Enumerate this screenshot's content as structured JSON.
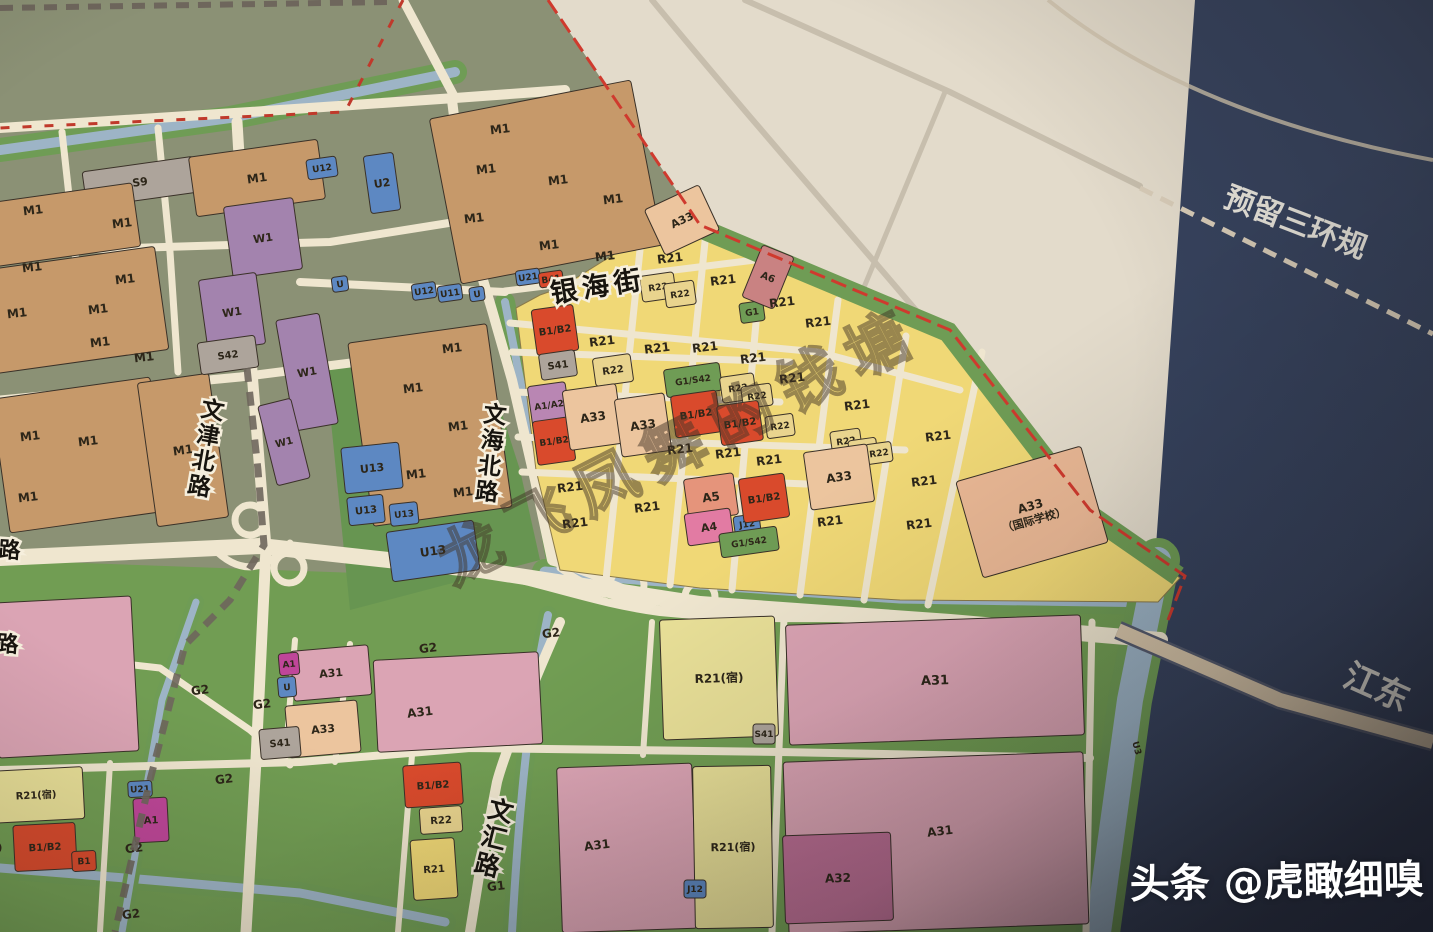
{
  "palette": {
    "m1": "#c6996a",
    "w1": "#a383ae",
    "s": "#ada49b",
    "u": "#5d88c2",
    "r21": "#f0d876",
    "r21s": "#e9e098",
    "r22": "#e9d48e",
    "b12": "#d94a2c",
    "a12": "#b986b3",
    "a33": "#ecc59e",
    "school": "#eab895",
    "a4": "#e27ba3",
    "a5": "#e5947b",
    "a6": "#c98282",
    "a1m": "#bf4699",
    "g": "#6f9c55",
    "pink": "#dba4b4",
    "a32": "#bd6f95",
    "none": ""
  },
  "annotations": {
    "reserved_corridor": {
      "text": "预留三环规"
    },
    "east_river_road": {
      "text": "江东"
    },
    "map_watermark": {
      "text": "龙飞凤舞的钱塘"
    },
    "photo_watermark": {
      "text": "头条 @虎瞰细嗅"
    }
  },
  "streets": [
    {
      "n": "银海街",
      "x": 598,
      "y": 286,
      "r": -9,
      "v": false,
      "s": 27
    },
    {
      "n": "文津北路",
      "x": 206,
      "y": 448,
      "r": 10,
      "v": true,
      "s": 23
    },
    {
      "n": "文海北路",
      "x": 491,
      "y": 453,
      "r": 6,
      "v": true,
      "s": 23
    },
    {
      "n": "文汇路",
      "x": 494,
      "y": 838,
      "r": 14,
      "v": true,
      "s": 25
    },
    {
      "n": "路",
      "x": 12,
      "y": 550,
      "r": 4,
      "v": false,
      "s": 22
    },
    {
      "n": "路",
      "x": 10,
      "y": 644,
      "r": 4,
      "v": false,
      "s": 22
    }
  ],
  "zones": [
    {
      "l": "S9",
      "x": 140,
      "y": 182,
      "w": 112,
      "h": 36,
      "r": -8,
      "c": "s",
      "s": 11
    },
    {
      "l": "",
      "x": 62,
      "y": 225,
      "w": 150,
      "h": 64,
      "r": -8,
      "c": "m1"
    },
    {
      "l": "M1",
      "x": 33,
      "y": 210,
      "w": 0,
      "c": "none"
    },
    {
      "l": "M1",
      "x": 122,
      "y": 223,
      "w": 0,
      "c": "none"
    },
    {
      "l": "M1",
      "x": 257,
      "y": 178,
      "w": 130,
      "h": 60,
      "r": -8,
      "c": "m1"
    },
    {
      "l": "",
      "x": 75,
      "y": 310,
      "w": 175,
      "h": 104,
      "r": -8,
      "c": "m1"
    },
    {
      "l": "M1",
      "x": 32,
      "y": 267,
      "w": 0,
      "c": "none"
    },
    {
      "l": "M1",
      "x": 125,
      "y": 279,
      "w": 0,
      "c": "none"
    },
    {
      "l": "M1",
      "x": 17,
      "y": 313,
      "w": 0,
      "c": "none"
    },
    {
      "l": "M1",
      "x": 98,
      "y": 309,
      "w": 0,
      "c": "none"
    },
    {
      "l": "M1",
      "x": 100,
      "y": 342,
      "w": 0,
      "c": "none"
    },
    {
      "l": "M1",
      "x": 144,
      "y": 357,
      "w": 0,
      "c": "none"
    },
    {
      "l": "",
      "x": 80,
      "y": 455,
      "w": 160,
      "h": 135,
      "r": -8,
      "c": "m1"
    },
    {
      "l": "M1",
      "x": 30,
      "y": 436,
      "w": 0,
      "c": "none"
    },
    {
      "l": "M1",
      "x": 88,
      "y": 441,
      "w": 0,
      "c": "none"
    },
    {
      "l": "M1",
      "x": 28,
      "y": 497,
      "w": 0,
      "c": "none"
    },
    {
      "l": "M1",
      "x": 183,
      "y": 450,
      "w": 72,
      "h": 145,
      "r": -8,
      "c": "m1"
    },
    {
      "l": "W1",
      "x": 263,
      "y": 238,
      "w": 70,
      "h": 72,
      "r": -8,
      "c": "w1",
      "s": 11
    },
    {
      "l": "W1",
      "x": 232,
      "y": 312,
      "w": 58,
      "h": 72,
      "r": -8,
      "c": "w1",
      "s": 11
    },
    {
      "l": "S42",
      "x": 228,
      "y": 355,
      "w": 58,
      "h": 32,
      "r": -8,
      "c": "s",
      "s": 10
    },
    {
      "l": "W1",
      "x": 307,
      "y": 372,
      "w": 44,
      "h": 112,
      "r": -10,
      "c": "w1",
      "s": 11
    },
    {
      "l": "W1",
      "x": 284,
      "y": 442,
      "w": 34,
      "h": 82,
      "r": -14,
      "c": "w1",
      "s": 10
    },
    {
      "l": "U12",
      "x": 322,
      "y": 168,
      "w": 30,
      "h": 20,
      "r": -8,
      "c": "u",
      "s": 9
    },
    {
      "l": "U2",
      "x": 382,
      "y": 183,
      "w": 30,
      "h": 58,
      "r": -8,
      "c": "u",
      "s": 11
    },
    {
      "l": "",
      "x": 546,
      "y": 182,
      "w": 205,
      "h": 168,
      "r": -11,
      "c": "m1"
    },
    {
      "l": "M1",
      "x": 500,
      "y": 129,
      "w": 0,
      "c": "none"
    },
    {
      "l": "M1",
      "x": 486,
      "y": 169,
      "w": 0,
      "c": "none"
    },
    {
      "l": "M1",
      "x": 558,
      "y": 180,
      "w": 0,
      "c": "none"
    },
    {
      "l": "M1",
      "x": 613,
      "y": 199,
      "w": 0,
      "c": "none"
    },
    {
      "l": "M1",
      "x": 474,
      "y": 218,
      "w": 0,
      "c": "none"
    },
    {
      "l": "M1",
      "x": 549,
      "y": 245,
      "w": 0,
      "c": "none"
    },
    {
      "l": "M1",
      "x": 605,
      "y": 256,
      "w": 0,
      "c": "none"
    },
    {
      "l": "A33",
      "x": 682,
      "y": 220,
      "w": 60,
      "h": 50,
      "r": -25,
      "c": "a33",
      "s": 11
    },
    {
      "l": "",
      "x": 430,
      "y": 425,
      "w": 140,
      "h": 185,
      "r": -8,
      "c": "m1"
    },
    {
      "l": "M1",
      "x": 452,
      "y": 348,
      "w": 0,
      "c": "none"
    },
    {
      "l": "M1",
      "x": 413,
      "y": 388,
      "w": 0,
      "c": "none"
    },
    {
      "l": "M1",
      "x": 458,
      "y": 426,
      "w": 0,
      "c": "none"
    },
    {
      "l": "M1",
      "x": 416,
      "y": 474,
      "w": 0,
      "c": "none"
    },
    {
      "l": "M1",
      "x": 463,
      "y": 492,
      "w": 0,
      "c": "none"
    },
    {
      "l": "U",
      "x": 340,
      "y": 284,
      "w": 16,
      "h": 15,
      "r": -8,
      "c": "u",
      "s": 9
    },
    {
      "l": "U12",
      "x": 424,
      "y": 291,
      "w": 24,
      "h": 16,
      "r": -8,
      "c": "u",
      "s": 9
    },
    {
      "l": "U11",
      "x": 450,
      "y": 293,
      "w": 24,
      "h": 16,
      "r": -8,
      "c": "u",
      "s": 9
    },
    {
      "l": "U",
      "x": 477,
      "y": 294,
      "w": 15,
      "h": 14,
      "r": -8,
      "c": "u",
      "s": 9
    },
    {
      "l": "U21",
      "x": 528,
      "y": 277,
      "w": 24,
      "h": 15,
      "r": -8,
      "c": "u",
      "s": 9
    },
    {
      "l": "B41",
      "x": 551,
      "y": 279,
      "w": 24,
      "h": 15,
      "r": -8,
      "c": "b12",
      "s": 9
    },
    {
      "l": "U13",
      "x": 372,
      "y": 468,
      "w": 58,
      "h": 46,
      "r": -6,
      "c": "u",
      "s": 11
    },
    {
      "l": "U13",
      "x": 366,
      "y": 510,
      "w": 36,
      "h": 28,
      "r": -6,
      "c": "u",
      "s": 10
    },
    {
      "l": "U13",
      "x": 404,
      "y": 514,
      "w": 28,
      "h": 22,
      "r": -6,
      "c": "u",
      "s": 9
    },
    {
      "l": "U13",
      "x": 433,
      "y": 551,
      "w": 88,
      "h": 50,
      "r": -8,
      "c": "u",
      "s": 12
    },
    {
      "l": "B1/B2",
      "x": 555,
      "y": 330,
      "w": 42,
      "h": 46,
      "r": -8,
      "c": "b12",
      "s": 10
    },
    {
      "l": "S41",
      "x": 558,
      "y": 365,
      "w": 36,
      "h": 26,
      "r": -8,
      "c": "s",
      "s": 10
    },
    {
      "l": "A1/A2",
      "x": 549,
      "y": 405,
      "w": 38,
      "h": 42,
      "r": -8,
      "c": "a12",
      "s": 9
    },
    {
      "l": "B1/B2",
      "x": 554,
      "y": 441,
      "w": 38,
      "h": 44,
      "r": -8,
      "c": "b12",
      "s": 9
    },
    {
      "l": "R22",
      "x": 613,
      "y": 370,
      "w": 38,
      "h": 28,
      "r": -8,
      "c": "r22",
      "s": 10
    },
    {
      "l": "A33",
      "x": 593,
      "y": 417,
      "w": 54,
      "h": 60,
      "r": -8,
      "c": "a33",
      "s": 12
    },
    {
      "l": "A33",
      "x": 643,
      "y": 425,
      "w": 50,
      "h": 58,
      "r": -8,
      "c": "a33",
      "s": 12
    },
    {
      "l": "R22",
      "x": 658,
      "y": 287,
      "w": 34,
      "h": 26,
      "r": -8,
      "c": "r22",
      "s": 9
    },
    {
      "l": "R22",
      "x": 680,
      "y": 294,
      "w": 30,
      "h": 24,
      "r": -8,
      "c": "r22",
      "s": 9
    },
    {
      "l": "G1/S42",
      "x": 693,
      "y": 380,
      "w": 56,
      "h": 28,
      "r": -8,
      "c": "g",
      "s": 9
    },
    {
      "l": "B1/B2",
      "x": 696,
      "y": 414,
      "w": 46,
      "h": 42,
      "r": -8,
      "c": "b12",
      "s": 10
    },
    {
      "l": "A5",
      "x": 711,
      "y": 497,
      "w": 50,
      "h": 42,
      "r": -8,
      "c": "a5",
      "s": 12
    },
    {
      "l": "A4",
      "x": 709,
      "y": 527,
      "w": 46,
      "h": 32,
      "r": -8,
      "c": "a4",
      "s": 11
    },
    {
      "l": "J12",
      "x": 747,
      "y": 524,
      "w": 26,
      "h": 18,
      "r": -8,
      "c": "u",
      "s": 9
    },
    {
      "l": "G1/S42",
      "x": 749,
      "y": 542,
      "w": 58,
      "h": 24,
      "r": -8,
      "c": "g",
      "s": 9
    },
    {
      "l": "G1",
      "x": 752,
      "y": 312,
      "w": 24,
      "h": 20,
      "r": -8,
      "c": "g",
      "s": 9
    },
    {
      "l": "A6",
      "x": 768,
      "y": 277,
      "w": 34,
      "h": 56,
      "r": 22,
      "c": "a6",
      "s": 10
    },
    {
      "l": "R22",
      "x": 738,
      "y": 388,
      "w": 34,
      "h": 26,
      "r": -8,
      "c": "r22",
      "s": 9
    },
    {
      "l": "R22",
      "x": 757,
      "y": 396,
      "w": 30,
      "h": 22,
      "r": -8,
      "c": "r22",
      "s": 9
    },
    {
      "l": "B1/B2",
      "x": 740,
      "y": 423,
      "w": 42,
      "h": 40,
      "r": -8,
      "c": "b12",
      "s": 10
    },
    {
      "l": "R22",
      "x": 780,
      "y": 426,
      "w": 28,
      "h": 22,
      "r": -8,
      "c": "r22",
      "s": 9
    },
    {
      "l": "B1/B2",
      "x": 764,
      "y": 498,
      "w": 46,
      "h": 44,
      "r": -8,
      "c": "b12",
      "s": 10
    },
    {
      "l": "R22",
      "x": 846,
      "y": 441,
      "w": 30,
      "h": 22,
      "r": -8,
      "c": "r22",
      "s": 9
    },
    {
      "l": "R22",
      "x": 863,
      "y": 449,
      "w": 28,
      "h": 20,
      "r": -8,
      "c": "r22",
      "s": 9
    },
    {
      "l": "R22",
      "x": 879,
      "y": 453,
      "w": 26,
      "h": 20,
      "r": -8,
      "c": "r22",
      "s": 9
    },
    {
      "l": "A33",
      "x": 839,
      "y": 477,
      "w": 64,
      "h": 58,
      "r": -8,
      "c": "a33",
      "s": 12
    },
    {
      "l": "A33",
      "l2": "（国际学校）",
      "x": 1032,
      "y": 512,
      "w": 130,
      "h": 100,
      "r": -16,
      "c": "school",
      "s": 12
    },
    {
      "l": "R21",
      "x": 670,
      "y": 258,
      "w": 0,
      "c": "none"
    },
    {
      "l": "R21",
      "x": 723,
      "y": 280,
      "w": 0,
      "c": "none"
    },
    {
      "l": "R21",
      "x": 782,
      "y": 302,
      "w": 0,
      "c": "none"
    },
    {
      "l": "R21",
      "x": 818,
      "y": 322,
      "w": 0,
      "c": "none"
    },
    {
      "l": "R21",
      "x": 602,
      "y": 341,
      "w": 0,
      "c": "none"
    },
    {
      "l": "R21",
      "x": 657,
      "y": 348,
      "w": 0,
      "c": "none"
    },
    {
      "l": "R21",
      "x": 705,
      "y": 347,
      "w": 0,
      "c": "none"
    },
    {
      "l": "R21",
      "x": 753,
      "y": 358,
      "w": 0,
      "c": "none"
    },
    {
      "l": "R21",
      "x": 792,
      "y": 378,
      "w": 0,
      "c": "none"
    },
    {
      "l": "R21",
      "x": 857,
      "y": 405,
      "w": 0,
      "c": "none"
    },
    {
      "l": "R21",
      "x": 938,
      "y": 436,
      "w": 0,
      "c": "none"
    },
    {
      "l": "R21",
      "x": 680,
      "y": 449,
      "w": 0,
      "c": "none"
    },
    {
      "l": "R21",
      "x": 728,
      "y": 453,
      "w": 0,
      "c": "none"
    },
    {
      "l": "R21",
      "x": 769,
      "y": 460,
      "w": 0,
      "c": "none"
    },
    {
      "l": "R21",
      "x": 924,
      "y": 481,
      "w": 0,
      "c": "none"
    },
    {
      "l": "R21",
      "x": 570,
      "y": 487,
      "w": 0,
      "c": "none"
    },
    {
      "l": "R21",
      "x": 647,
      "y": 507,
      "w": 0,
      "c": "none"
    },
    {
      "l": "R21",
      "x": 575,
      "y": 523,
      "w": 0,
      "c": "none"
    },
    {
      "l": "R21",
      "x": 830,
      "y": 521,
      "w": 0,
      "c": "none"
    },
    {
      "l": "R21",
      "x": 919,
      "y": 524,
      "w": 0,
      "c": "none"
    },
    {
      "l": "",
      "x": 65,
      "y": 677,
      "w": 140,
      "h": 155,
      "r": -3,
      "c": "pink"
    },
    {
      "l": "A31",
      "x": 331,
      "y": 673,
      "w": 78,
      "h": 50,
      "r": -5,
      "c": "pink",
      "s": 11
    },
    {
      "l": "A1",
      "x": 289,
      "y": 664,
      "w": 20,
      "h": 22,
      "r": -5,
      "c": "a1m",
      "s": 9
    },
    {
      "l": "U",
      "x": 287,
      "y": 687,
      "w": 18,
      "h": 20,
      "r": -5,
      "c": "u",
      "s": 9
    },
    {
      "l": "A33",
      "x": 323,
      "y": 729,
      "w": 72,
      "h": 52,
      "r": -5,
      "c": "a33",
      "s": 11
    },
    {
      "l": "S41",
      "x": 280,
      "y": 743,
      "w": 40,
      "h": 30,
      "r": -5,
      "c": "s",
      "s": 10
    },
    {
      "l": "",
      "x": 458,
      "y": 702,
      "w": 165,
      "h": 92,
      "r": -3,
      "c": "pink"
    },
    {
      "l": "A31",
      "x": 420,
      "y": 712,
      "w": 0,
      "c": "none"
    },
    {
      "l": "G2",
      "x": 428,
      "y": 648,
      "w": 0,
      "c": "none"
    },
    {
      "l": "G2",
      "x": 551,
      "y": 633,
      "w": 0,
      "c": "none"
    },
    {
      "l": "R21(宿)",
      "x": 719,
      "y": 678,
      "w": 115,
      "h": 120,
      "r": -2,
      "c": "r21s",
      "s": 12
    },
    {
      "l": "S41",
      "x": 764,
      "y": 734,
      "w": 22,
      "h": 20,
      "r": 0,
      "c": "s",
      "s": 9
    },
    {
      "l": "A31",
      "x": 935,
      "y": 680,
      "w": 295,
      "h": 120,
      "r": -2,
      "c": "pink",
      "s": 13
    },
    {
      "l": "B1/B2",
      "x": 433,
      "y": 785,
      "w": 58,
      "h": 42,
      "r": -4,
      "c": "b12",
      "s": 10
    },
    {
      "l": "R22",
      "x": 441,
      "y": 820,
      "w": 42,
      "h": 26,
      "r": -4,
      "c": "r22",
      "s": 10
    },
    {
      "l": "R21",
      "x": 434,
      "y": 869,
      "w": 44,
      "h": 60,
      "r": -4,
      "c": "r21",
      "s": 10
    },
    {
      "l": "G1",
      "x": 496,
      "y": 886,
      "w": 0,
      "c": "none"
    },
    {
      "l": "",
      "x": 627,
      "y": 848,
      "w": 135,
      "h": 165,
      "r": -2,
      "c": "pink"
    },
    {
      "l": "A31",
      "x": 597,
      "y": 845,
      "w": 0,
      "c": "none"
    },
    {
      "l": "R21(宿)",
      "x": 733,
      "y": 847,
      "w": 78,
      "h": 162,
      "r": -1,
      "c": "r21s",
      "s": 11
    },
    {
      "l": "J12",
      "x": 695,
      "y": 889,
      "w": 22,
      "h": 18,
      "r": 0,
      "c": "u",
      "s": 9
    },
    {
      "l": "",
      "x": 936,
      "y": 843,
      "w": 300,
      "h": 172,
      "r": -2,
      "c": "pink"
    },
    {
      "l": "A31",
      "x": 940,
      "y": 831,
      "w": 0,
      "c": "none"
    },
    {
      "l": "A32",
      "x": 838,
      "y": 878,
      "w": 108,
      "h": 88,
      "r": -2,
      "c": "a32",
      "s": 12
    },
    {
      "l": "R21(宿)",
      "x": 36,
      "y": 795,
      "w": 95,
      "h": 52,
      "r": -3,
      "c": "r21s",
      "s": 10
    },
    {
      "l": "B1/B2",
      "x": 45,
      "y": 847,
      "w": 62,
      "h": 46,
      "r": -3,
      "c": "b12",
      "s": 10
    },
    {
      "l": "B1",
      "x": 84,
      "y": 861,
      "w": 24,
      "h": 20,
      "r": -3,
      "c": "b12",
      "s": 9
    },
    {
      "l": "R21(宿)",
      "x": -18,
      "y": 849,
      "w": 0,
      "c": "none",
      "s": 10
    },
    {
      "l": "A1",
      "x": 151,
      "y": 820,
      "w": 34,
      "h": 44,
      "r": -3,
      "c": "a1m",
      "s": 10
    },
    {
      "l": "U21",
      "x": 140,
      "y": 789,
      "w": 24,
      "h": 16,
      "r": -3,
      "c": "u",
      "s": 9
    },
    {
      "l": "G2",
      "x": 200,
      "y": 690,
      "w": 0,
      "c": "none"
    },
    {
      "l": "G2",
      "x": 262,
      "y": 704,
      "w": 0,
      "c": "none"
    },
    {
      "l": "G2",
      "x": 224,
      "y": 779,
      "w": 0,
      "c": "none"
    },
    {
      "l": "G2",
      "x": 134,
      "y": 848,
      "w": 0,
      "c": "none"
    },
    {
      "l": "G2",
      "x": 131,
      "y": 914,
      "w": 0,
      "c": "none"
    },
    {
      "l": "U3",
      "x": 1137,
      "y": 748,
      "w": 0,
      "c": "none",
      "s": 9,
      "r": 75
    }
  ]
}
